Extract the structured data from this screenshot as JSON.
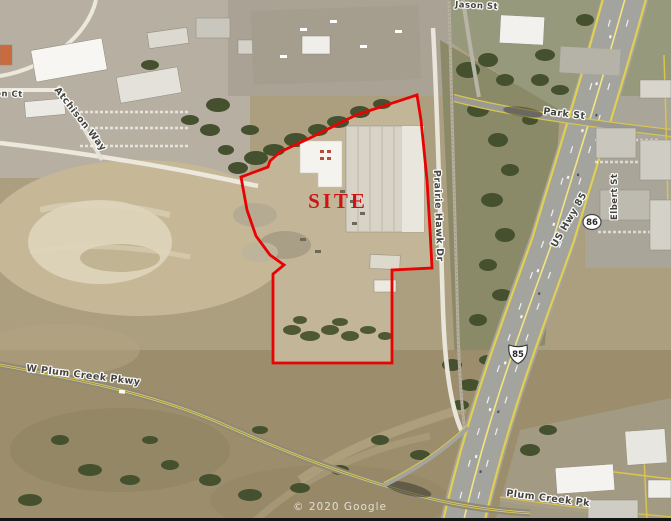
{
  "map": {
    "attribution": "© 2020 Google",
    "site": {
      "label": "SITE"
    },
    "streets": {
      "park_st": "Park St",
      "jason_st": "Jason St",
      "prairie_hawk_dr": "Prairie Hawk Dr",
      "us_hwy_85": "US Hwy 85",
      "elbert_st": "Elbert St",
      "atchison_way": "Atchison Way",
      "on_ct": "on Ct",
      "w_plum_creek_pkwy": "W Plum Creek Pkwy",
      "plum_creek_pkwy": "Plum Creek Pk"
    },
    "route_shields": {
      "us_85": "85",
      "co_86": "86"
    },
    "colors": {
      "site_outline": "#e80202",
      "site_label": "#cc1616",
      "road_yellow": "#e3cf4f",
      "highway_gray": "#a3a49e",
      "street_label_text": "#3f3f3a",
      "street_label_halo": "#ffffff",
      "terrain_tan": "#ac9f7f",
      "tree_green": "#45502f"
    }
  }
}
